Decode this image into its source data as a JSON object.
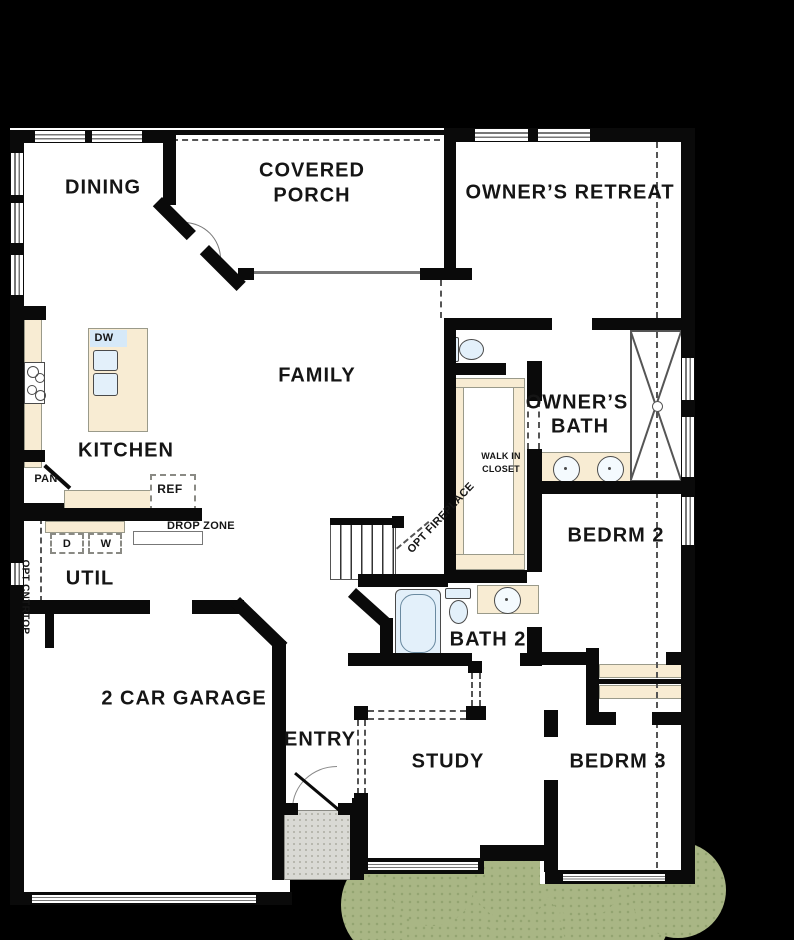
{
  "rooms": {
    "dining": {
      "label": "DINING"
    },
    "covered_porch": {
      "label_line1": "COVERED",
      "label_line2": "PORCH"
    },
    "owners_retreat": {
      "label": "OWNER’S RETREAT"
    },
    "family": {
      "label": "FAMILY"
    },
    "kitchen": {
      "label": "KITCHEN"
    },
    "util": {
      "label": "UTIL"
    },
    "owners_bath": {
      "label_line1": "OWNER’S",
      "label_line2": "BATH"
    },
    "walk_in_closet": {
      "label_line1": "WALK IN",
      "label_line2": "CLOSET"
    },
    "bedrm2": {
      "label": "BEDRM 2"
    },
    "bath2": {
      "label": "BATH 2"
    },
    "garage": {
      "label": "2 CAR GARAGE"
    },
    "entry": {
      "label": "ENTRY"
    },
    "study": {
      "label": "STUDY"
    },
    "bedrm3": {
      "label": "BEDRM 3"
    }
  },
  "annotations": {
    "dishwasher": {
      "label": "DW"
    },
    "pantry": {
      "label": "PAN"
    },
    "refrigerator": {
      "label": "REF"
    },
    "drop_zone": {
      "label": "DROP ZONE"
    },
    "dryer": {
      "label": "D"
    },
    "washer": {
      "label": "W"
    },
    "opt_countertop": {
      "label": "OPT CNTRTOP"
    },
    "opt_fireplace": {
      "label": "OPT FIREPLACE"
    }
  },
  "colors": {
    "background": "#000000",
    "wall": "#0a0a0a",
    "floor": "#ffffff",
    "counter": "#f8ecd3",
    "fixture": "#e3f0fa",
    "porch_concrete": "#d9d9d4",
    "shrub_green": "#a9b685",
    "dashed_line": "#555555",
    "text": "#151515"
  }
}
